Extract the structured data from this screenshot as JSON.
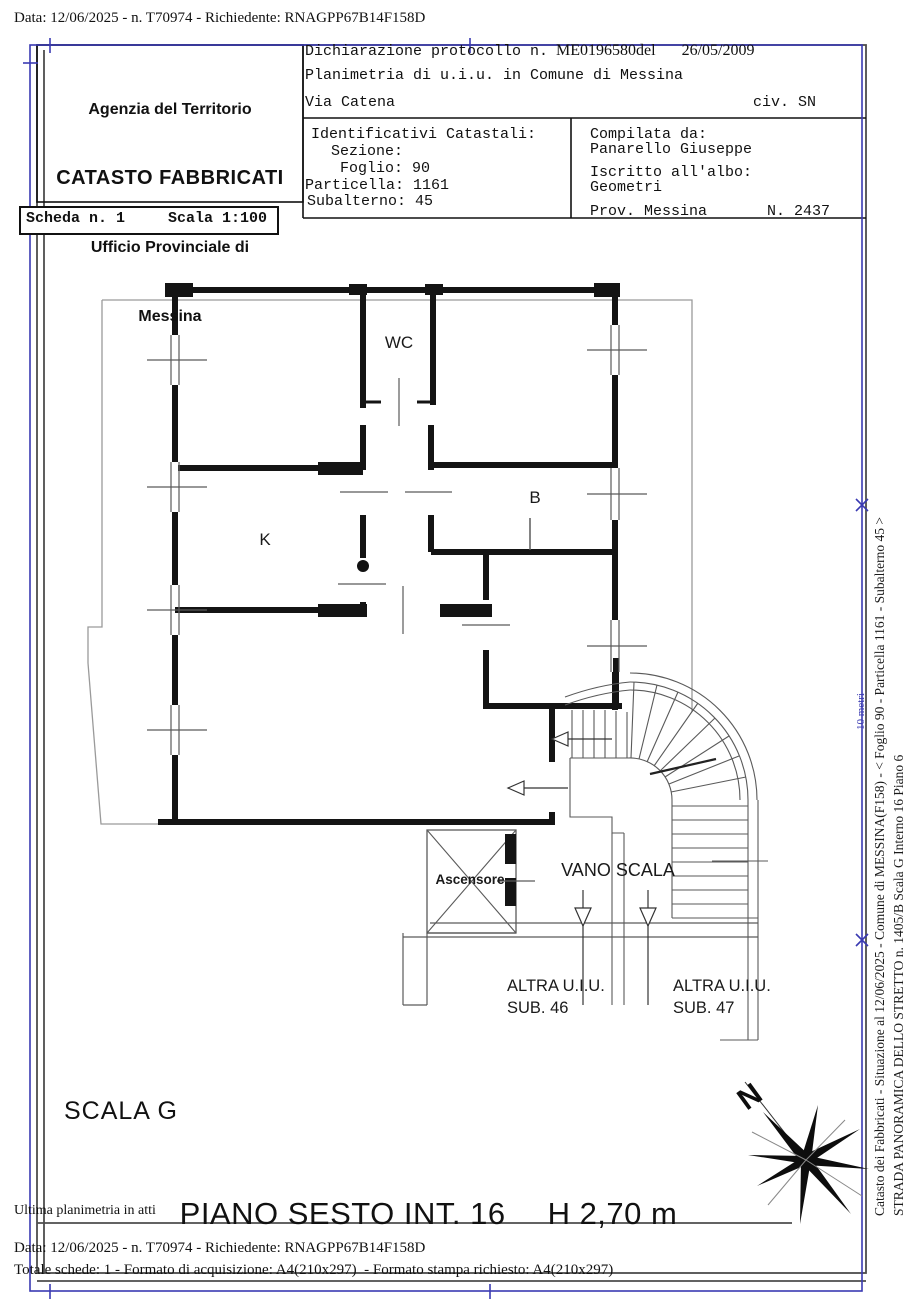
{
  "document": {
    "top_line": "Data: 12/06/2025 - n. T70974 - Richiedente: RNAGPP67B14F158D",
    "footer": {
      "ultima": "Ultima planimetria in atti",
      "data_line": "Data: 12/06/2025 - n. T70974 - Richiedente: RNAGPP67B14F158D",
      "totale_line": "Totale schede: 1 - Formato di acquisizione: A4(210x297)  - Formato stampa richiesto: A4(210x297)"
    }
  },
  "header": {
    "agency": {
      "line1": "Agenzia del Territorio",
      "line2": "CATASTO FABBRICATI",
      "line3": "Ufficio Provinciale di",
      "line4": "Messina"
    },
    "declaration": {
      "prefix": "Dichiarazione protocollo n.",
      "protocol": "ME0196580del",
      "date": "26/05/2009",
      "planimetria": "Planimetria di u.i.u. in Comune di Messina",
      "street": "Via Catena",
      "civico": "civ. SN"
    },
    "identifiers": {
      "lines": [
        "Identificativi Catastali:",
        "Sezione:",
        "Foglio: 90",
        "Particella: 1161",
        "Subalterno: 45"
      ]
    },
    "compiler": {
      "label": "Compilata da:",
      "name": "Panarello Giuseppe",
      "albo_label": "Iscritto all'albo:",
      "albo_value": "Geometri",
      "prov": "Prov. Messina",
      "number": "N. 2437"
    }
  },
  "sheet": {
    "scheda": "Scheda n. 1",
    "scala": "Scala 1:100"
  },
  "plan": {
    "rooms": {
      "wc": "WC",
      "k": "K",
      "b": "B"
    },
    "ascensore": "Ascensore",
    "vano_scala": "VANO SCALA",
    "sub46": {
      "line1": "ALTRA U.I.U.",
      "line2": "SUB. 46"
    },
    "sub47": {
      "line1": "ALTRA U.I.U.",
      "line2": "SUB. 47"
    },
    "scala_g": "SCALA G",
    "piano_title": "PIANO SESTO INT. 16",
    "piano_height": "H 2,70 m",
    "compass_n": "N",
    "scale_note": "10 metri"
  },
  "sidebar": {
    "line1": "Catasto dei Fabbricati - Situazione al 12/06/2025 - Comune di MESSINA(F158) - <  Foglio 90 - Particella 1161 - Subalterno 45 >",
    "line2": "STRADA PANORAMICA DELLO STRETTO n. 1405/B  Scala G Interno 16 Piano 6"
  },
  "colors": {
    "frame_blue": "#3a3ab2",
    "frame_gray": "#4d4d4d",
    "wall_black": "#141414",
    "thin_gray": "#5a5a5a",
    "balcony_gray": "#9a9a9a"
  }
}
